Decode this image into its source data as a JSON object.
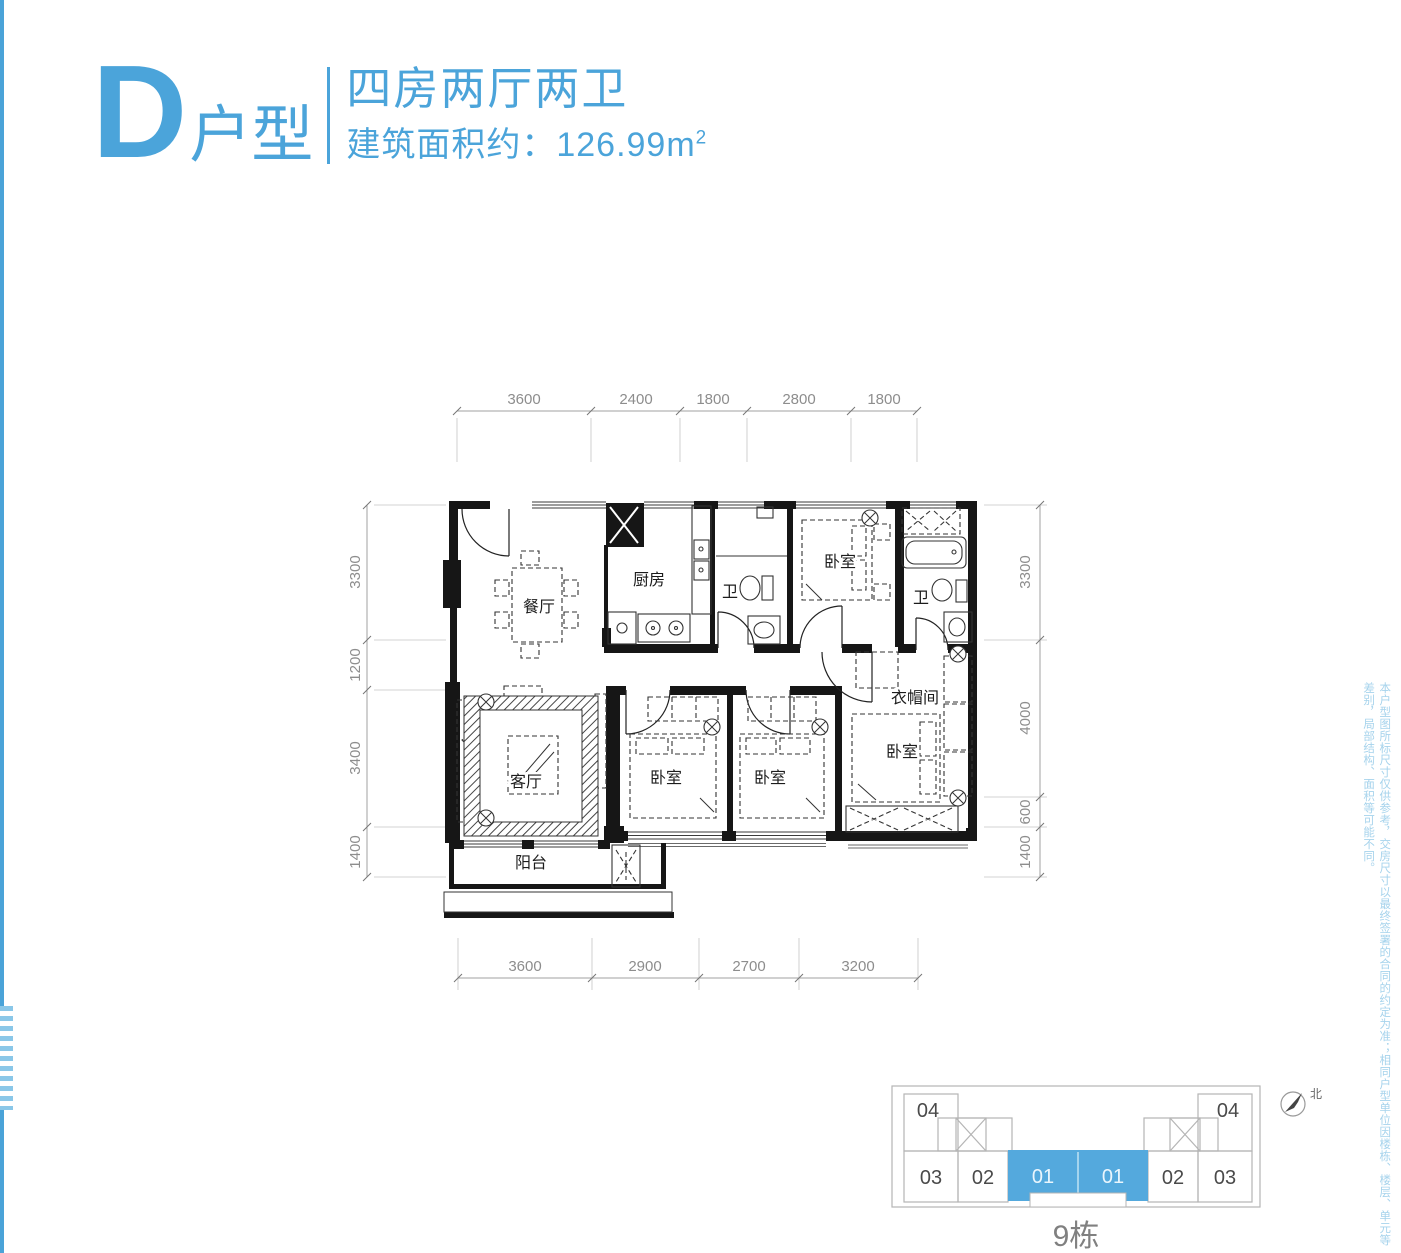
{
  "colors": {
    "accent": "#4BA4DA",
    "accent_light": "#A6D3EC",
    "wall": "#161616",
    "dim": "#8d8d8d",
    "keyplan_line": "#b5b5b5",
    "highlight": "#54A9DD"
  },
  "header": {
    "type_letter": "D",
    "type_word": "户型",
    "layout_title": "四房两厅两卫",
    "area_label": "建筑面积约：126.99m",
    "area_sup": "2"
  },
  "plan": {
    "rooms": {
      "dining": "餐厅",
      "kitchen": "厨房",
      "bath1": "卫",
      "bedroom_top": "卧室",
      "bath2": "卫",
      "cloakroom": "衣帽间",
      "bedroom_mid1": "卧室",
      "bedroom_mid2": "卧室",
      "bedroom_master": "卧室",
      "living": "客厅",
      "balcony": "阳台"
    },
    "dims_top": [
      "3600",
      "2400",
      "1800",
      "2800",
      "1800"
    ],
    "dims_bottom": [
      "3600",
      "2900",
      "2700",
      "3200"
    ],
    "dims_left": [
      "3300",
      "1200",
      "3400",
      "1400"
    ],
    "dims_right": [
      "3300",
      "4000",
      "600",
      "1400"
    ]
  },
  "key_plan": {
    "building": "9栋",
    "north": "北",
    "units": {
      "left_top": "04",
      "left_bottom_outer": "03",
      "left_bottom_inner": "02",
      "center_left": "01",
      "center_right": "01",
      "right_bottom_inner": "02",
      "right_bottom_outer": "03",
      "right_top": "04"
    }
  },
  "disclaimer": "本户型图所标尺寸仅供参考，交房尺寸以最终签署的合同的约定为准；相同户型单位因楼栋、楼层、单元等差别，局部结构、面积等可能不同。"
}
